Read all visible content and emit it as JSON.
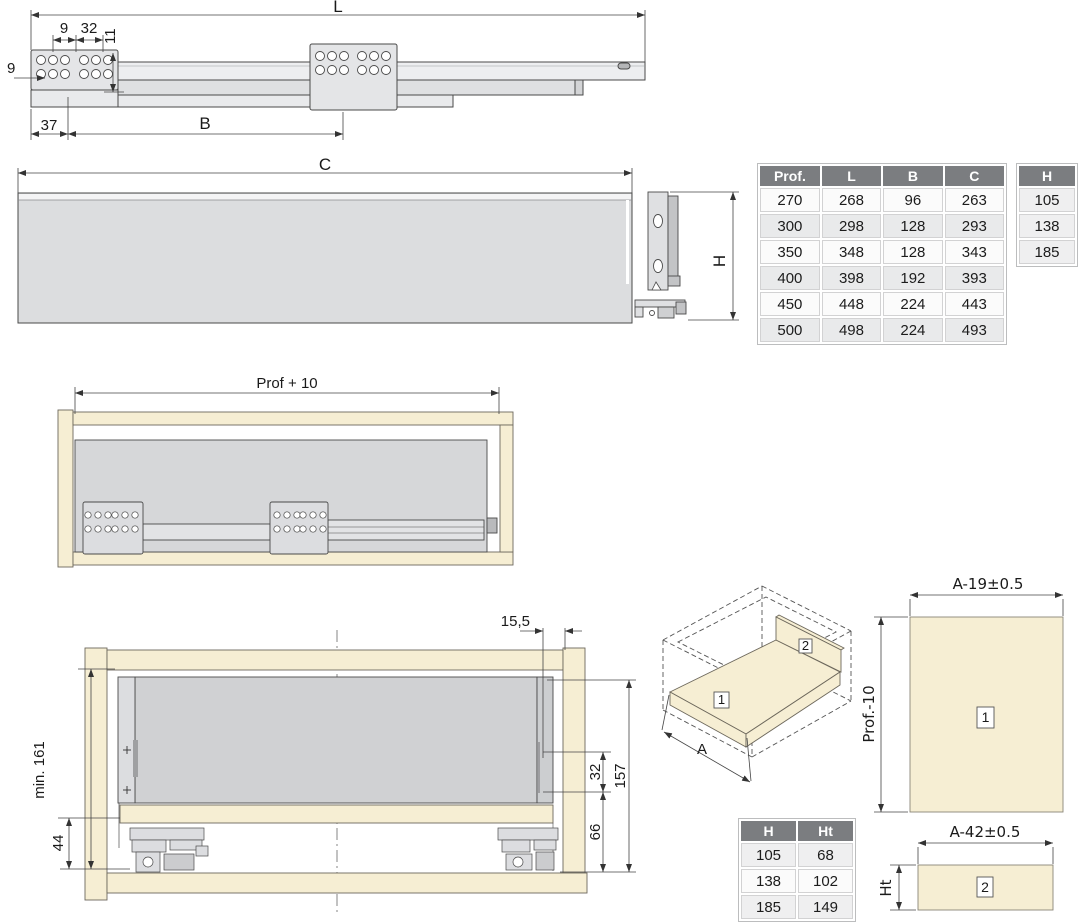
{
  "colors": {
    "beige": "#f6eed3",
    "panel_gray": "#d4d5d8",
    "rail_gray": "#e9eaec",
    "plate_gray": "#e4e5e7",
    "table_header_bg": "#7b7d80",
    "row_shaded": "#e9eaeb",
    "line": "#4a4a4a"
  },
  "top_view": {
    "dim_l": "L",
    "dim_9_top": "9",
    "dim_32": "32",
    "dim_11": "11",
    "dim_9_left": "9",
    "dim_37": "37",
    "dim_b": "B"
  },
  "c_panel": {
    "dim_c": "C"
  },
  "h_bracket": {
    "dim_h": "H"
  },
  "main_table": {
    "headers": [
      "Prof.",
      "L",
      "B",
      "C"
    ],
    "rows": [
      [
        "270",
        "268",
        "96",
        "263"
      ],
      [
        "300",
        "298",
        "128",
        "293"
      ],
      [
        "350",
        "348",
        "128",
        "343"
      ],
      [
        "400",
        "398",
        "192",
        "393"
      ],
      [
        "450",
        "448",
        "224",
        "443"
      ],
      [
        "500",
        "498",
        "224",
        "493"
      ]
    ]
  },
  "h_table": {
    "header": "H",
    "rows": [
      "105",
      "138",
      "185"
    ]
  },
  "prof10_view": {
    "dim": "Prof + 10"
  },
  "front_view": {
    "dim_min161": "min. 161",
    "dim_44": "44",
    "dim_155": "15,5",
    "dim_32": "32",
    "dim_157": "157",
    "dim_66": "66"
  },
  "iso_view": {
    "dim_a": "A",
    "label_1": "1",
    "label_2": "2"
  },
  "hht_table": {
    "headers": [
      "H",
      "Ht"
    ],
    "rows": [
      [
        "105",
        "68"
      ],
      [
        "138",
        "102"
      ],
      [
        "185",
        "149"
      ]
    ]
  },
  "panel_1": {
    "dim_top": "A-19±0.5",
    "dim_left": "Prof.-10",
    "label": "1"
  },
  "panel_2": {
    "dim_top": "A-42±0.5",
    "dim_left": "Ht",
    "label": "2"
  }
}
